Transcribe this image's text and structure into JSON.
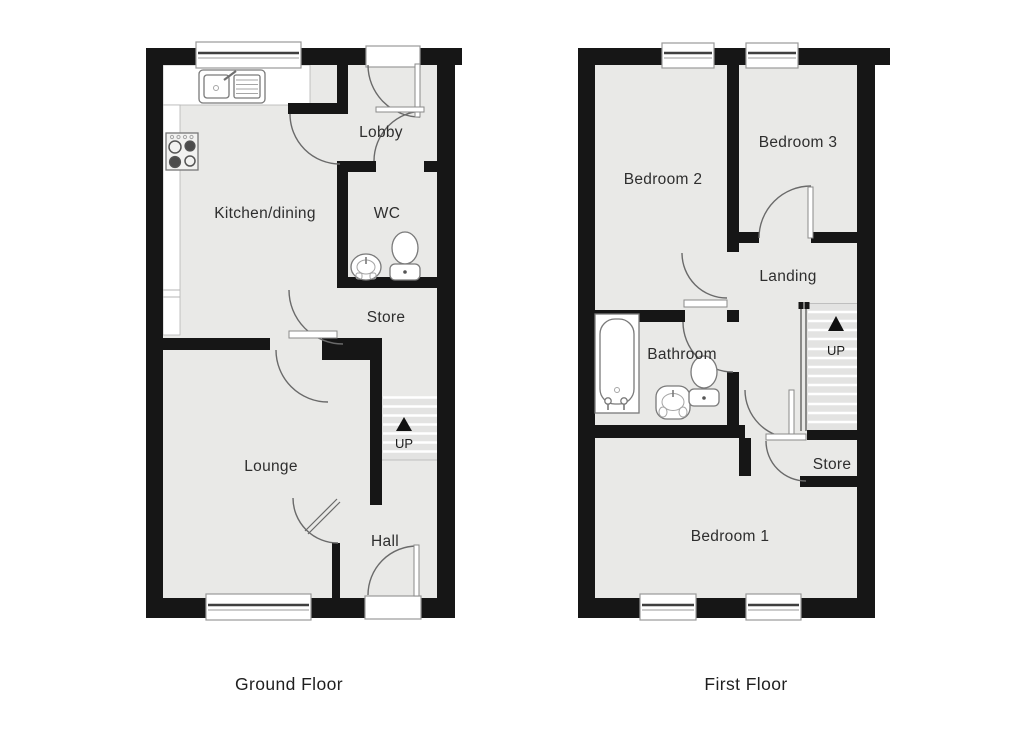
{
  "floors": [
    {
      "caption": "Ground Floor",
      "rooms": {
        "kitchen": "Kitchen/dining",
        "lobby": "Lobby",
        "wc": "WC",
        "store": "Store",
        "lounge": "Lounge",
        "hall": "Hall"
      },
      "stairs": {
        "label": "UP"
      },
      "fixtures": [
        "kitchen-sink",
        "hob",
        "toilet",
        "wash-basin"
      ],
      "windows": 2,
      "external_doors": 2
    },
    {
      "caption": "First Floor",
      "rooms": {
        "bedroom2": "Bedroom 2",
        "bedroom3": "Bedroom 3",
        "landing": "Landing",
        "bathroom": "Bathroom",
        "store": "Store",
        "bedroom1": "Bedroom 1"
      },
      "stairs": {
        "label": "UP"
      },
      "fixtures": [
        "bathtub",
        "wash-basin",
        "toilet"
      ],
      "windows": 4,
      "external_doors": 0
    }
  ],
  "colors": {
    "wall": "#161616",
    "room_fill": "#e9e9e7",
    "stair_fill": "#e3e3e2",
    "arc_line": "#6a6a6a",
    "fixture_line": "#7a7a7a",
    "window_line": "#3f3f3f",
    "text": "#2e2e2e",
    "caption": "#1f1f1f",
    "background": "#ffffff"
  }
}
